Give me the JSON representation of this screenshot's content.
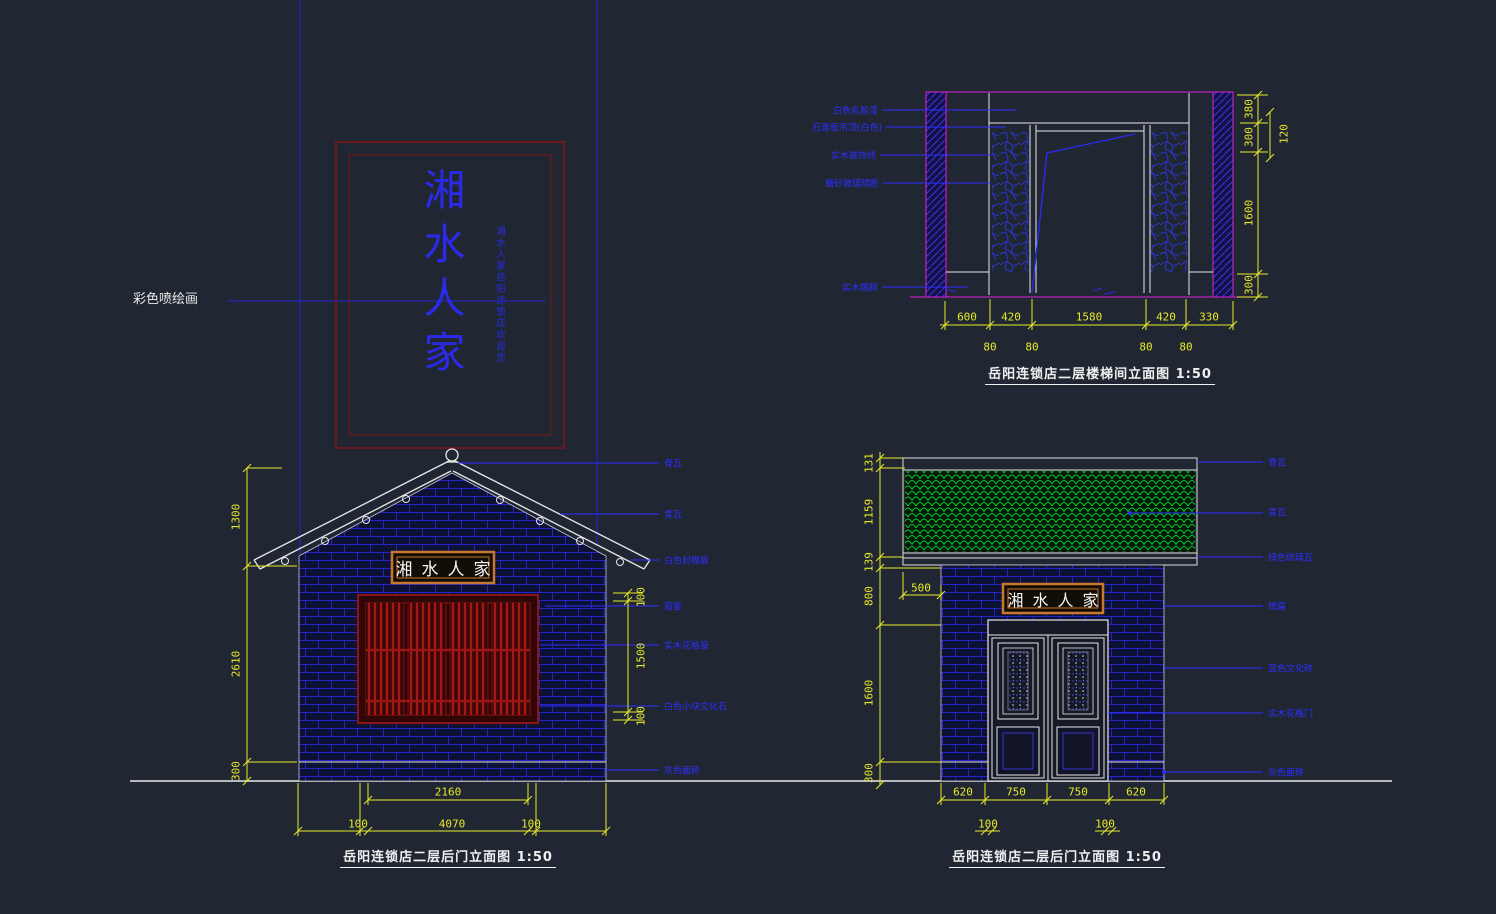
{
  "app": {
    "background": "#202732",
    "dim_color": "#E8E82A",
    "annotation_color": "#2E2EFF"
  },
  "banner": {
    "label": "彩色喷绘画",
    "main_text": "湘水人家",
    "side_text": "湘水人家岳阳连锁店欢迎您"
  },
  "stair": {
    "title": "岳阳连锁店二层楼梯间立面图 1:50",
    "labels": [
      "白色乳胶漆",
      "石膏板吊顶(白色)",
      "实木装饰线",
      "磨砂玻璃隔断",
      "实木踢脚"
    ],
    "dims_right": [
      "380",
      "300",
      "1600",
      "300"
    ],
    "dim_offset_right": "120",
    "dims_bottom": [
      "600",
      "420",
      "1580",
      "420",
      "330"
    ],
    "dims_sub": [
      "80",
      "80",
      "80",
      "80"
    ]
  },
  "left_elev": {
    "title": "岳阳连锁店二层后门立面图 1:50",
    "plaque": "湘水人家",
    "labels": [
      "脊瓦",
      "青瓦",
      "白色封檐板",
      "窗套",
      "实木花格窗",
      "白色小块文化石",
      "灰色面砖"
    ],
    "dims_left": [
      "1300",
      "2610",
      "300"
    ],
    "dims_window": [
      "100",
      "1500",
      "100"
    ],
    "dim_opening": "2160",
    "dim_total": "4070",
    "dims_sub": [
      "100",
      "100"
    ]
  },
  "right_elev": {
    "title": "岳阳连锁店二层后门立面图 1:50",
    "plaque": "湘水人家",
    "labels": [
      "脊瓦",
      "青瓦",
      "绿色琉璃瓦",
      "牌匾",
      "蓝色文化砖",
      "实木花格门",
      "灰色面砖"
    ],
    "dims_left": [
      "131",
      "1159",
      "139",
      "800",
      "1600",
      "300"
    ],
    "dim_sign_offset": "500",
    "dims_bottom": [
      "620",
      "750",
      "750",
      "620"
    ],
    "dims_sub": [
      "100",
      "100"
    ]
  }
}
